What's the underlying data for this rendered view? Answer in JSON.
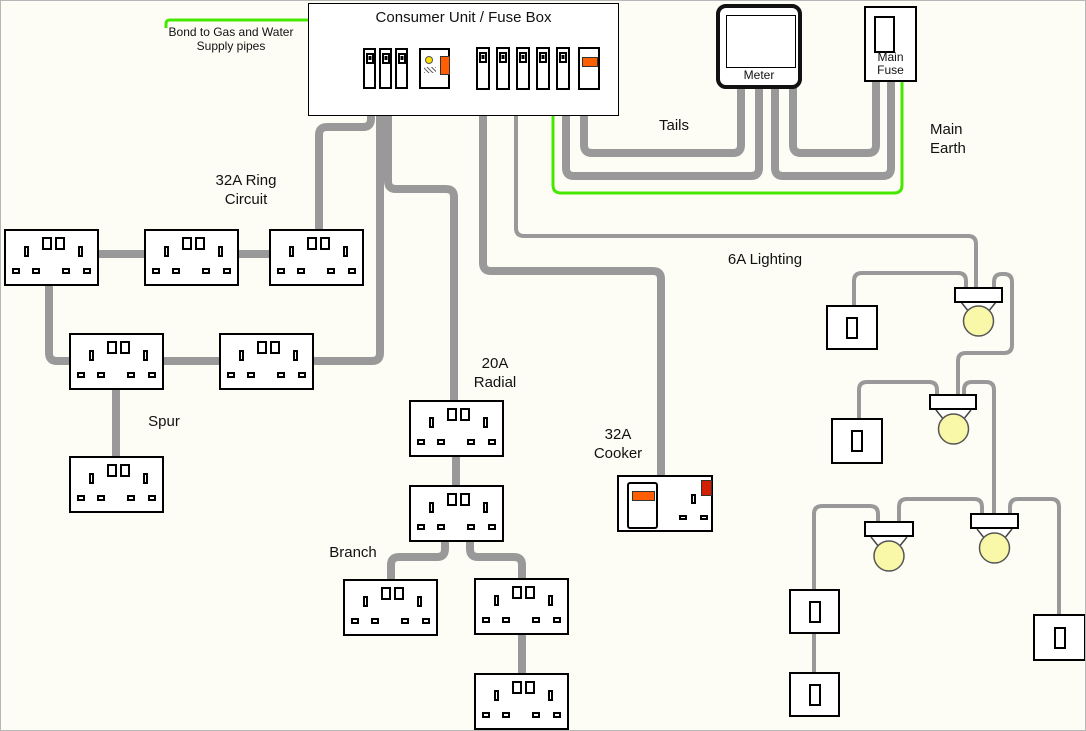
{
  "diagram": {
    "title": "Consumer Unit / Fuse Box",
    "labels": {
      "bond": {
        "line1": "Bond to Gas and Water",
        "line2": "Supply pipes"
      },
      "tails": "Tails",
      "main_earth": {
        "line1": "Main",
        "line2": "Earth"
      },
      "ring": {
        "line1": "32A Ring",
        "line2": "Circuit"
      },
      "lighting": "6A Lighting",
      "spur": "Spur",
      "radial": {
        "line1": "20A",
        "line2": "Radial"
      },
      "cooker": {
        "line1": "32A",
        "line2": "Cooker"
      },
      "branch": "Branch"
    },
    "meter": {
      "label": "Meter"
    },
    "main_fuse": {
      "line1": "Main",
      "line2": "Fuse"
    },
    "consumer_unit": {
      "mcb_left_count": 3,
      "mcb_right_count": 5,
      "has_rcd": true,
      "has_main_switch": true
    },
    "inventory": {
      "double_sockets": 11,
      "light_switches": 5,
      "ceiling_lights": 4,
      "meters": 1,
      "main_fuses": 1,
      "cooker_units": 1
    },
    "colors": {
      "wire_gray": "#999999",
      "earth_green": "#46e800",
      "switch_orange": "#ff5f00",
      "indicator_red": "#d22000",
      "test_button_yellow": "#ffe000",
      "bulb_yellow": "#f8f8a8"
    }
  }
}
